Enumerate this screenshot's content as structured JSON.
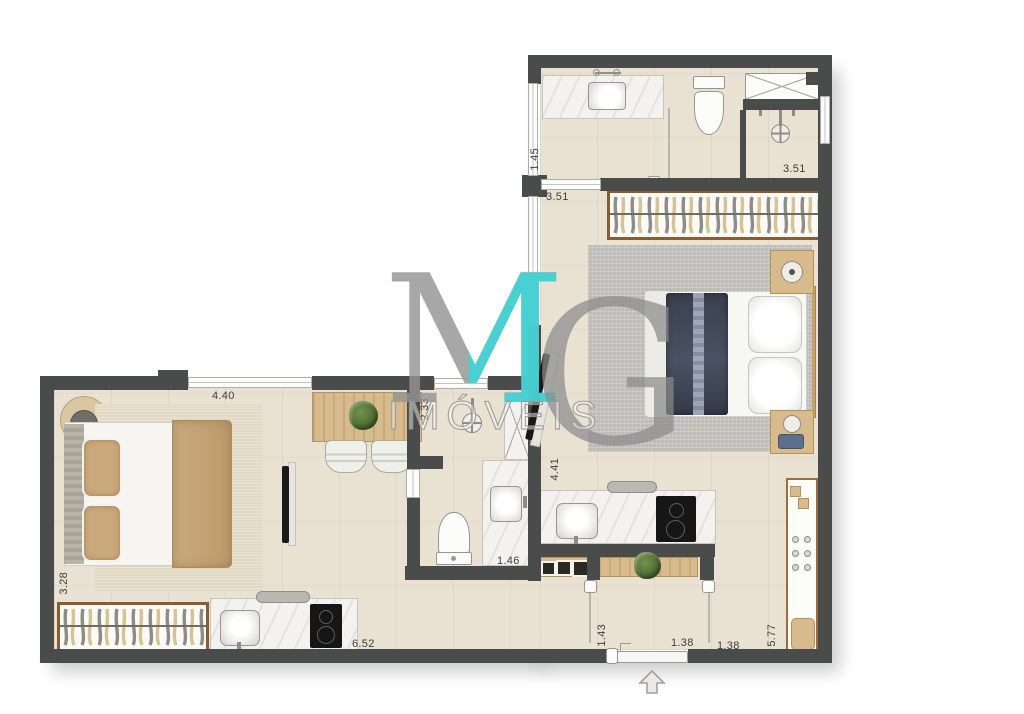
{
  "watermark": {
    "m": "M",
    "g": "G",
    "name": "IMÓVEIS"
  },
  "colors": {
    "accent_teal": "#3ed6d8",
    "wall": "#4a4c4b",
    "floor": "#e9e2d3",
    "wood": "#d8bb8d",
    "duvet_navy": "#3d4553"
  },
  "dims": {
    "bed1_width": "4.40",
    "unit1_depth": "3.28",
    "unit1_width": "6.52",
    "bath1_shower": "2.33",
    "bath1_width": "1.46",
    "bath2_door": "1.45",
    "hall2_width": "3.51",
    "bath2_width": "3.51",
    "kitchen2_depth": "4.41",
    "entry_left": "1.43",
    "entry_mid": "1.38",
    "entry_right": "1.38",
    "unit2_depth": "5.77"
  }
}
